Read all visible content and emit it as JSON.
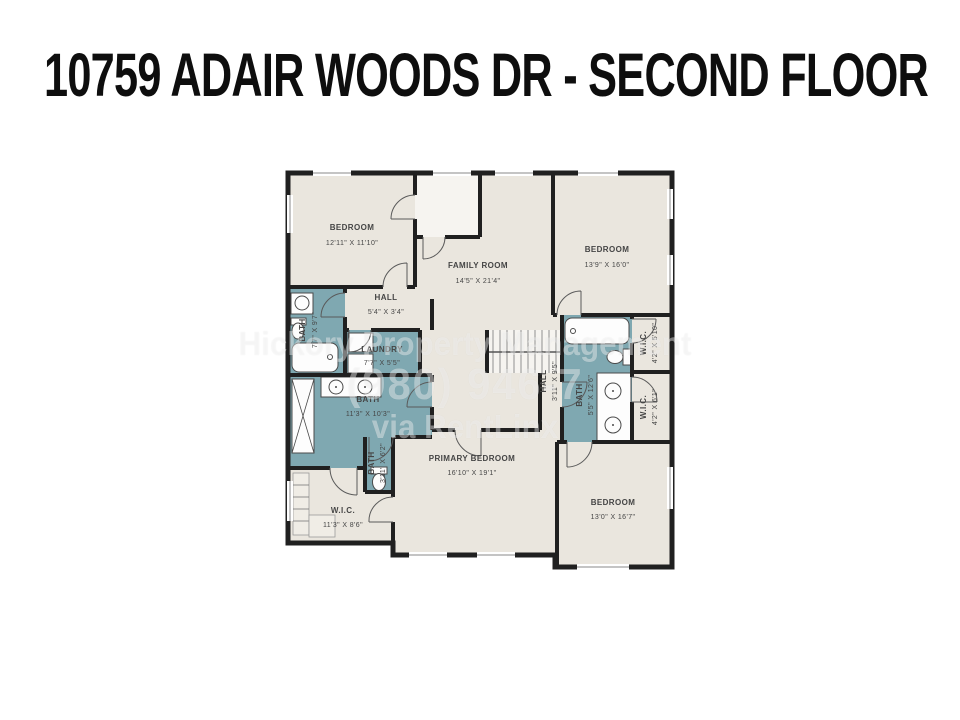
{
  "title": "10759 ADAIR WOODS DR - SECOND FLOOR",
  "watermark": {
    "line1": "Hickory Property Management",
    "line2": "(980) 946-7",
    "line3": "via RentLinx"
  },
  "colors": {
    "background": "#ffffff",
    "floor": "#eae6de",
    "wet": "#7fa8b1",
    "wall": "#202020",
    "label": "#454545"
  },
  "rooms": {
    "bedroom_tl": {
      "name": "BEDROOM",
      "dims": "12'11\" X 11'10\""
    },
    "family": {
      "name": "FAMILY ROOM",
      "dims": "14'5\" X 21'4\""
    },
    "bedroom_tr": {
      "name": "BEDROOM",
      "dims": "13'9\" X 16'0\""
    },
    "hall_top": {
      "name": "HALL",
      "dims": "5'4\" X 3'4\""
    },
    "bath_left": {
      "name": "BATH",
      "dims": "7'7\" X 9'7\""
    },
    "laundry": {
      "name": "LAUNDRY",
      "dims": "7'7\" X 5'5\""
    },
    "hall_right": {
      "name": "HALL",
      "dims": "3'11\" X 9'5\""
    },
    "bath_right": {
      "name": "BATH",
      "dims": "5'5\" X 12'6\""
    },
    "wic_right_top": {
      "name": "W.I.C.",
      "dims": "4'2\" X 5'10\""
    },
    "wic_right_bottom": {
      "name": "W.I.C.",
      "dims": "4'2\" X 6'1\""
    },
    "bath_center": {
      "name": "BATH",
      "dims": "11'3\" X 10'3\""
    },
    "water_closet": {
      "name": "BATH",
      "dims": "3'11\" X 6'2\""
    },
    "wic_left": {
      "name": "W.I.C.",
      "dims": "11'3\" X 8'6\""
    },
    "primary": {
      "name": "PRIMARY BEDROOM",
      "dims": "16'10\" X 19'1\""
    },
    "bedroom_br": {
      "name": "BEDROOM",
      "dims": "13'0\" X 16'7\""
    }
  }
}
